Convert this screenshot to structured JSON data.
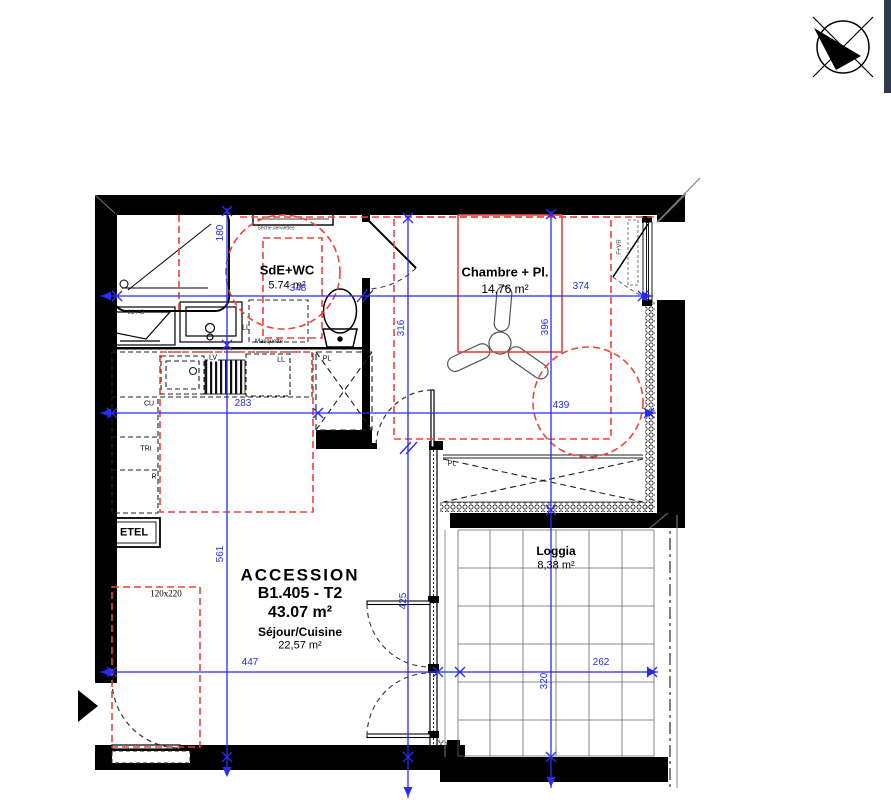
{
  "rooms": {
    "bathroom": {
      "name": "SdE+WC",
      "area": "5.74 m²"
    },
    "bedroom": {
      "name": "Chambre + Pl.",
      "area": "14,76 m²"
    },
    "living": {
      "program": "ACCESSION",
      "unit": "B1.405 - T2",
      "unit_area": "43.07 m²",
      "name": "Séjour/Cuisine",
      "area": "22,57 m²"
    },
    "loggia": {
      "name": "Loggia",
      "area": "8,38 m²"
    }
  },
  "annotations": {
    "towel_dryer": "Sèche serviettes",
    "washbasin": "81 /43",
    "washer_bathroom": "LL",
    "masking_panel": "Masquette",
    "dishwasher": "LV",
    "washer_kitchen": "LL",
    "kitchen_unit": "CU",
    "sorting_bin": "TRI",
    "fridge": "R",
    "electrical_box": "ETEL",
    "closet_hall": "PL",
    "closet_bedroom": "PL",
    "door_clearance": "120x220",
    "window_type": "F+VR"
  },
  "dimensions": {
    "d348": "348",
    "d374": "374",
    "d283": "283",
    "d439": "439",
    "d447": "447",
    "d262": "262",
    "d180": "180",
    "d561": "561",
    "d316": "316",
    "d425": "425",
    "d396": "396",
    "d320": "320"
  },
  "icons": {
    "north_arrow": "north-compass-icon",
    "entrance_arrow": "entrance-direction-icon"
  },
  "colors": {
    "dimension_blue": "#2a2af5",
    "zone_red": "#ee4338",
    "wall_black": "#000000"
  }
}
